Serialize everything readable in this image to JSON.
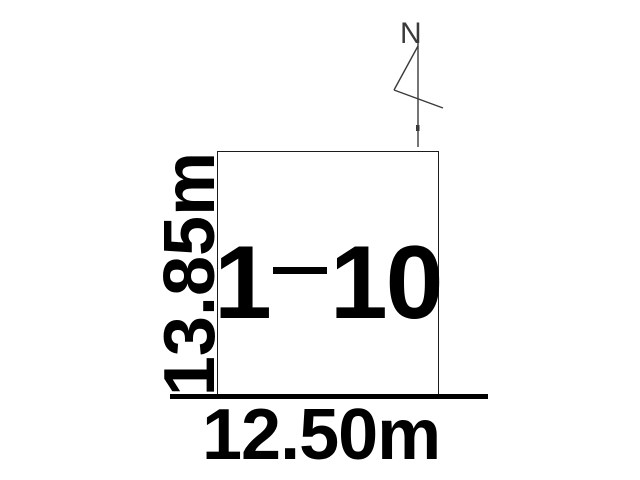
{
  "diagram": {
    "lot": {
      "label": "1-10",
      "label_prefix": "1",
      "label_suffix": "10"
    },
    "dimensions": {
      "width_label": "12.50m",
      "height_label": "13.85m"
    },
    "north_indicator": {
      "label": "N"
    },
    "colors": {
      "background": "#ffffff",
      "line": "#000000",
      "thin_line": "#3a3a3a",
      "text": "#000000"
    }
  }
}
